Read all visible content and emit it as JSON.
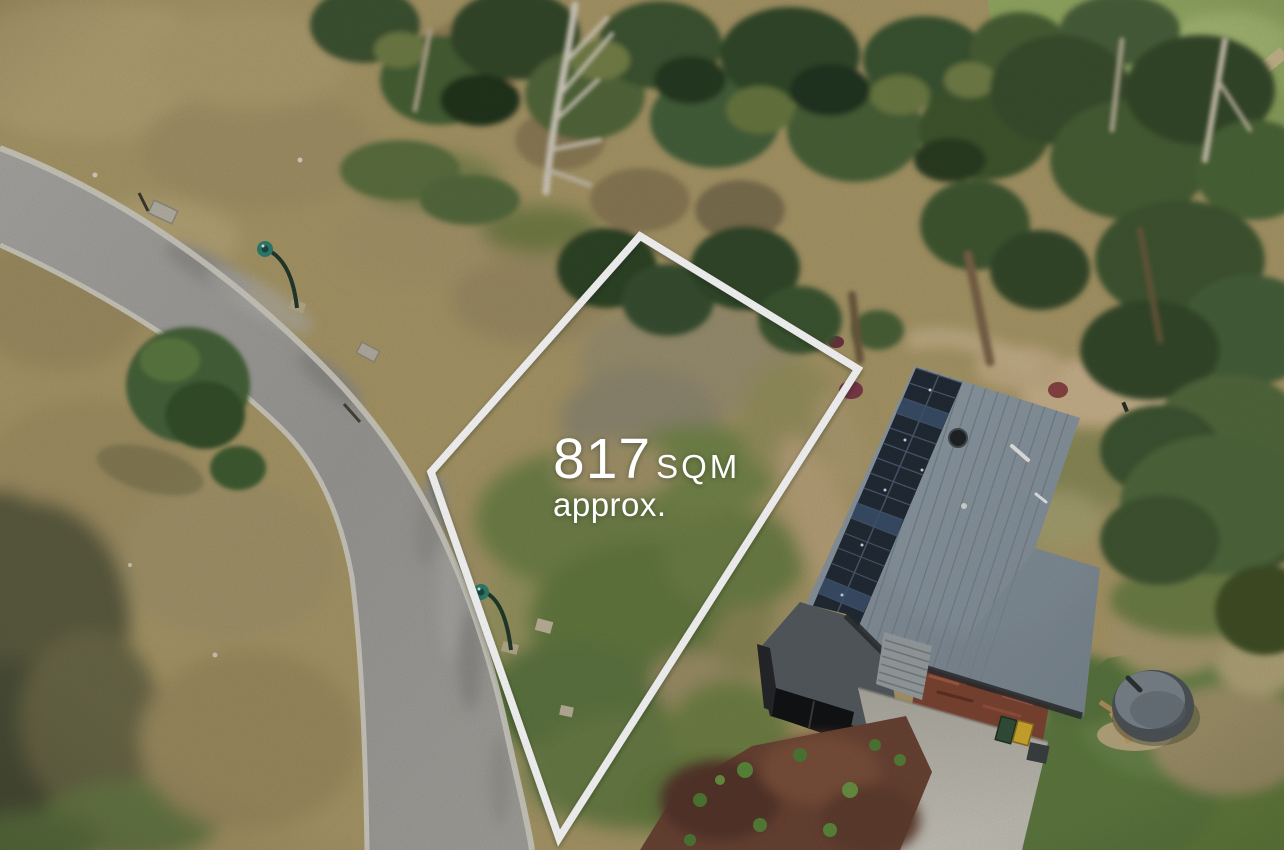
{
  "overlay": {
    "area_value": "817",
    "area_unit": "SQM",
    "area_qualifier": "approx.",
    "text_color": "#ffffff",
    "boundary_color": "#ffffff"
  },
  "scene": {
    "dry_grass": "#ab9a6c",
    "lot_grass": "#6f8148",
    "forest_green": "#3c5430",
    "pasture_green": "#94aa64",
    "road_surface": "#9e9d99",
    "road_curb": "#cfccc2",
    "house_roof": "#87939d",
    "solar_panels": "#222b36",
    "house_walls": "#25272a",
    "brick_wall": "#7d4533",
    "garage_door": "#121315",
    "driveway": "#bab7ae",
    "mulch_bed": "#6a4434",
    "lawn": "#66803f",
    "water_tank": "#4e5458",
    "street_lamp_head": "#2e7f71",
    "bin_yellow": "#d1ab2e",
    "bin_green": "#33503a"
  }
}
